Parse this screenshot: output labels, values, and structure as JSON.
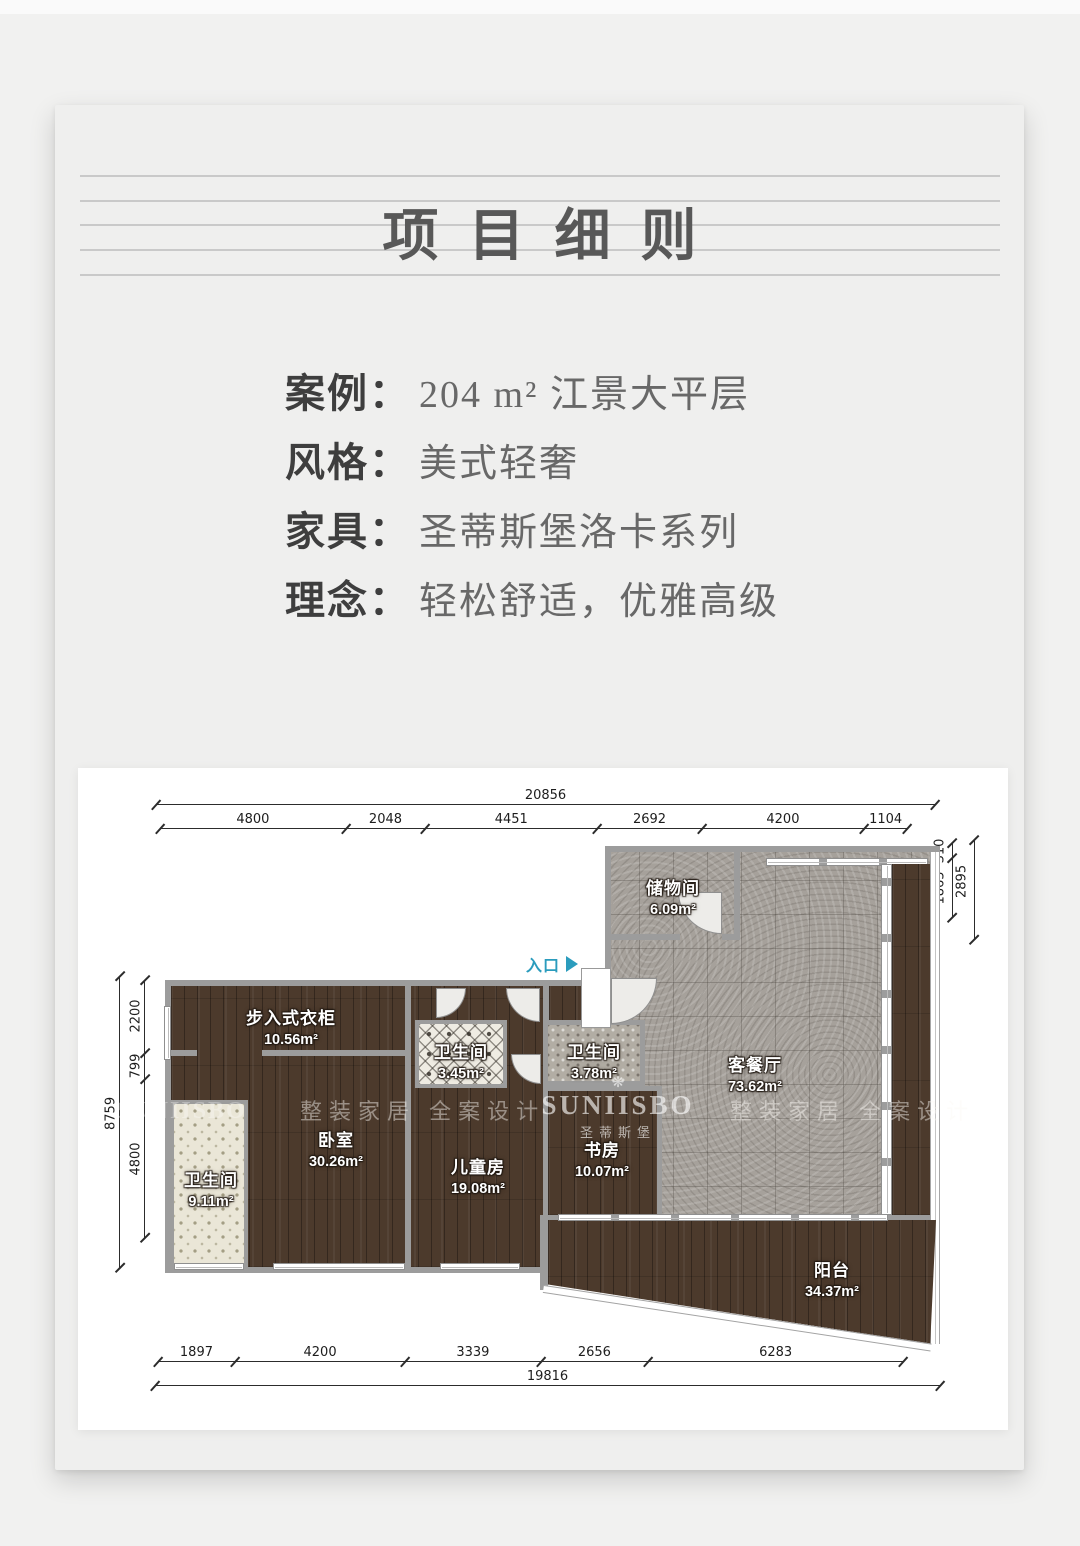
{
  "title": "项目细则",
  "details": [
    {
      "label": "案例：",
      "value": "204 m² 江景大平层"
    },
    {
      "label": "风格：",
      "value": "美式轻奢"
    },
    {
      "label": "家具：",
      "value": "圣蒂斯堡洛卡系列"
    },
    {
      "label": "理念：",
      "value": "轻松舒适，优雅高级"
    }
  ],
  "floorplan": {
    "entry": "入口",
    "rooms": {
      "storage": {
        "name": "储物间",
        "area": "6.09m²"
      },
      "living": {
        "name": "客餐厅",
        "area": "73.62m²"
      },
      "closet": {
        "name": "步入式衣柜",
        "area": "10.56m²"
      },
      "bath_small": {
        "name": "卫生间",
        "area": "3.45m²"
      },
      "bath_mid": {
        "name": "卫生间",
        "area": "3.78m²"
      },
      "bedroom": {
        "name": "卧室",
        "area": "30.26m²"
      },
      "kids": {
        "name": "儿童房",
        "area": "19.08m²"
      },
      "study": {
        "name": "书房",
        "area": "10.07m²"
      },
      "bath_left": {
        "name": "卫生间",
        "area": "9.11m²"
      },
      "balcony": {
        "name": "阳台",
        "area": "34.37m²"
      }
    },
    "dims": {
      "top": {
        "total": 20856,
        "segments": [
          4800,
          2048,
          4451,
          2692,
          4200,
          1104
        ]
      },
      "bottom": {
        "total": 19816,
        "segments": [
          1897,
          4200,
          3339,
          2656,
          6283
        ]
      },
      "left": {
        "total": 8759,
        "segments": [
          2200,
          799,
          4800
        ]
      },
      "right": {
        "total": 2895,
        "segments": [
          310,
          1865
        ]
      }
    },
    "watermark": {
      "brand": "SUNIISBO",
      "brand_cn": "圣蒂斯堡",
      "flower": "❋",
      "slogan": "整装家居 全案设计"
    }
  },
  "colors": {
    "accent_teal": "#2b9cbd",
    "wall": "#9c9c9c"
  }
}
